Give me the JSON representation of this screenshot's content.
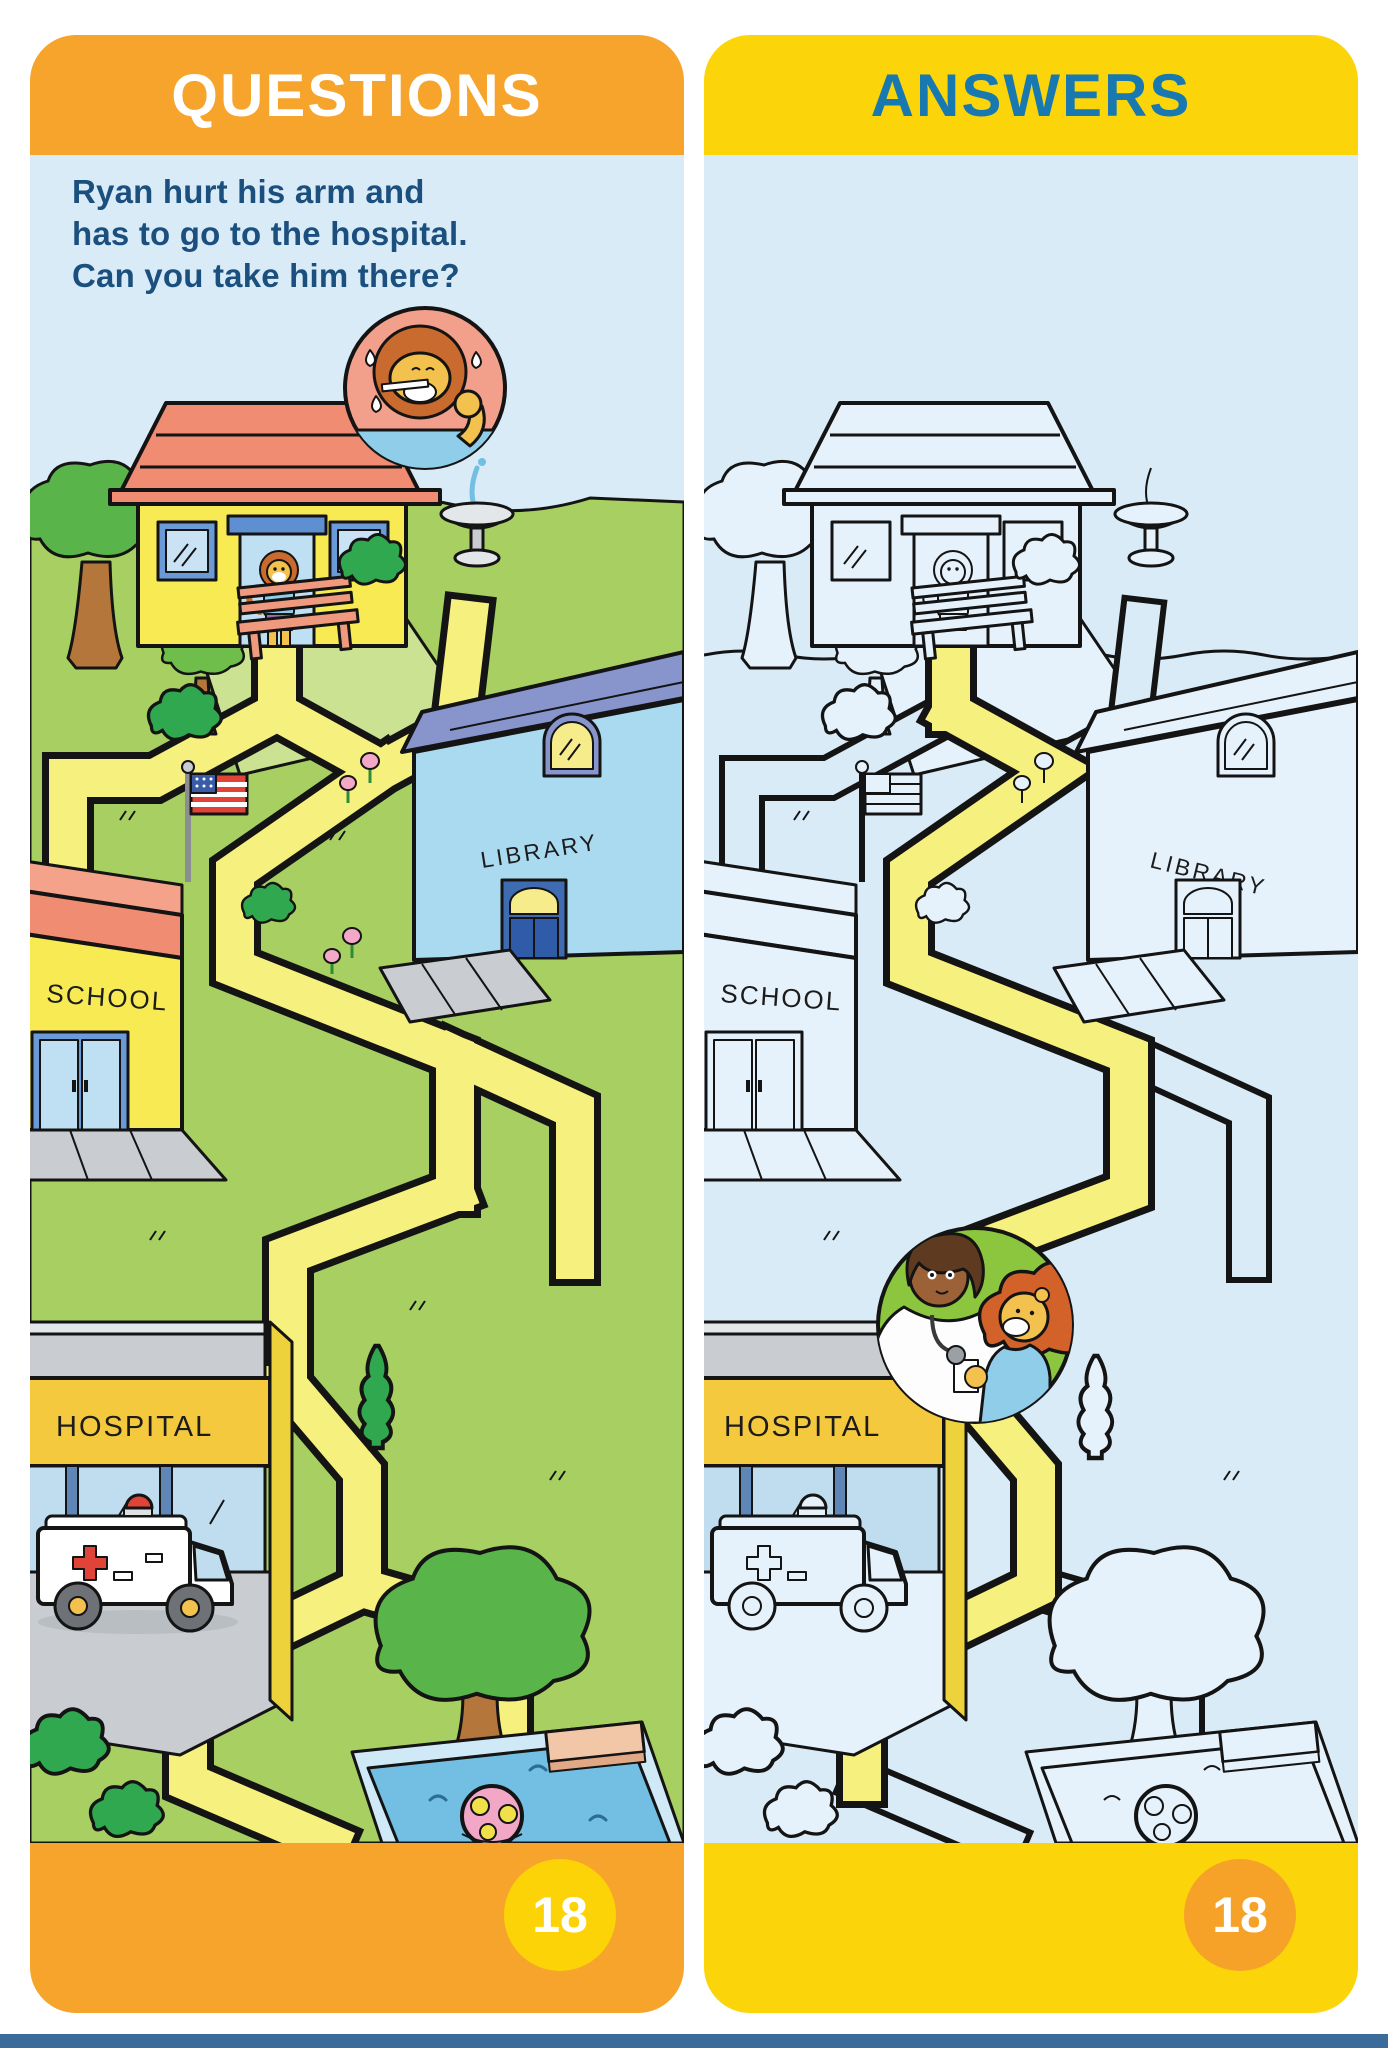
{
  "book_page": {
    "left": {
      "header": "QUESTIONS",
      "question": [
        "Ryan hurt his arm and",
        "has to go to the hospital.",
        "Can you take him there?",
        "Start at his house."
      ],
      "labels": {
        "school": "SCHOOL",
        "library": "LIBRARY",
        "hospital": "HOSPITAL"
      },
      "page_number": "18"
    },
    "right": {
      "header": "ANSWERS",
      "labels": {
        "school": "SCHOOL",
        "library": "LIBRARY",
        "hospital": "HOSPITAL"
      },
      "page_number": "18"
    }
  },
  "colors": {
    "header_orange": "#F6A42B",
    "header_yellow": "#FBD40A",
    "answers_text_blue": "#1878B0",
    "question_text_navy": "#1B4F7E",
    "panel_background_blue": "#D9EBF7",
    "maze_path_yellow": "#F6F07E",
    "grass_green": "#A7CF62",
    "page_badge_yellow": "#FCD307",
    "page_badge_orange": "#F6A228"
  },
  "scene": {
    "start": "lion (Ryan) at his house",
    "destination": "hospital",
    "questions_inset": "crying lion with thermometer",
    "answers_inset": "doctor hugging lion",
    "landmarks": [
      "house",
      "school",
      "library",
      "hospital",
      "ambulance",
      "bench",
      "fountain",
      "flag",
      "trees",
      "bushes",
      "flowers",
      "swimming pool",
      "beach ball",
      "diving board"
    ]
  }
}
